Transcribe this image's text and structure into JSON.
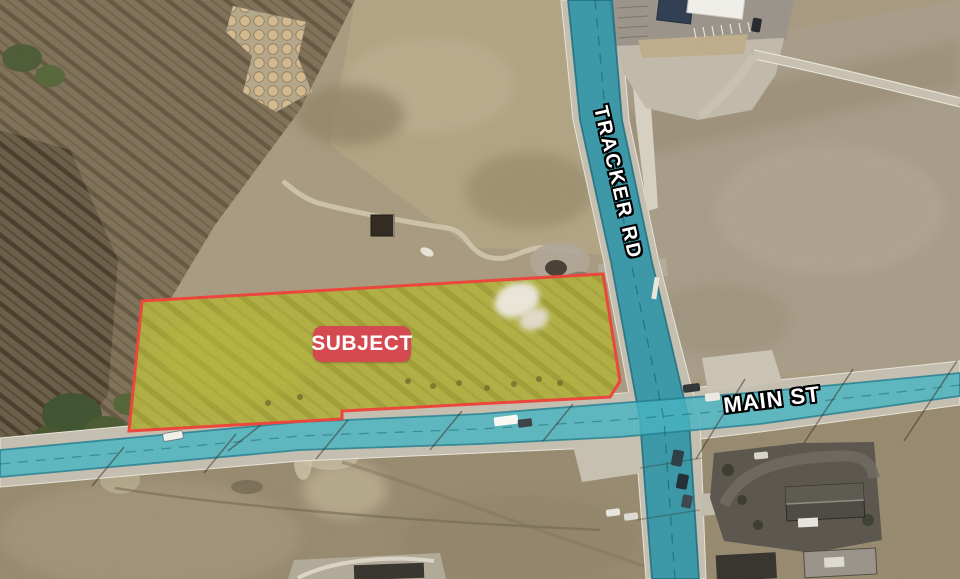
{
  "map": {
    "subject_badge": {
      "label": "SUBJECT"
    },
    "road_labels": {
      "tracker": "TRACKER RD",
      "main": "MAIN ST"
    },
    "colors": {
      "highlight_teal_dark": "#2492a6",
      "highlight_teal_light": "#43b4c3",
      "parcel_outline_red": "#ee4338",
      "parcel_fill_yellow": "#d8d32a",
      "badge_red": "#d54a50",
      "badge_text_color": "#ffffff"
    }
  }
}
